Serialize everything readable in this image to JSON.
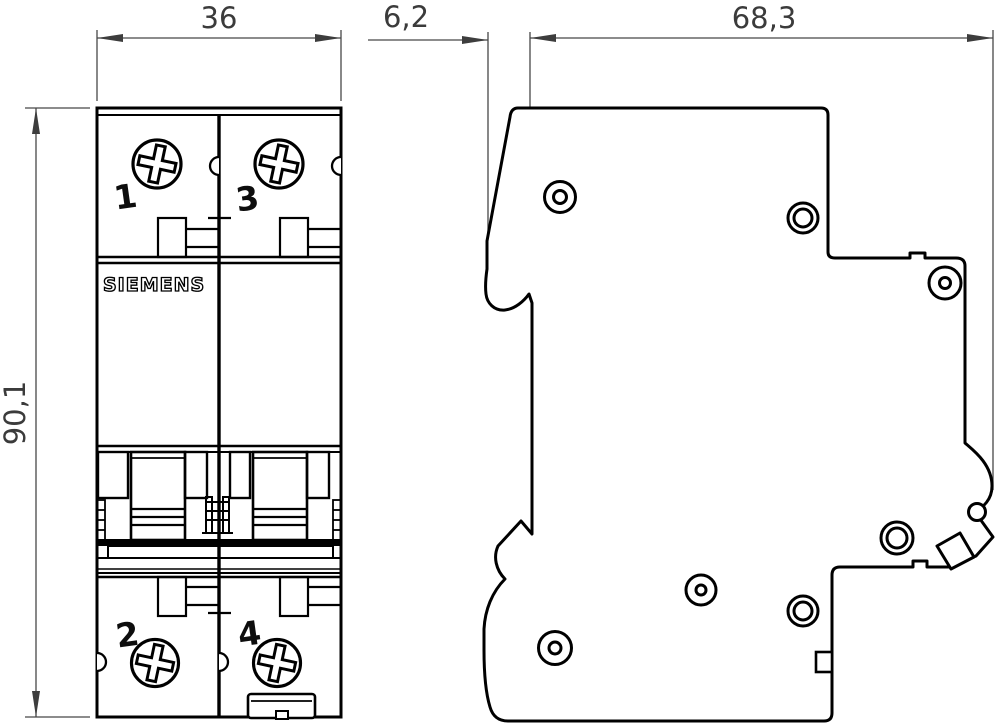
{
  "views": {
    "front": {
      "brand": "SIEMENS",
      "terminal_top_left": "1",
      "terminal_top_right": "3",
      "terminal_bottom_left": "2",
      "terminal_bottom_right": "4"
    }
  },
  "dimensions": {
    "front_width": "36",
    "front_height": "90,1",
    "side_rail_offset": "6,2",
    "side_depth": "68,3"
  },
  "colors": {
    "outline": "#000000",
    "dimension_lines": "#474747",
    "background": "#ffffff"
  }
}
